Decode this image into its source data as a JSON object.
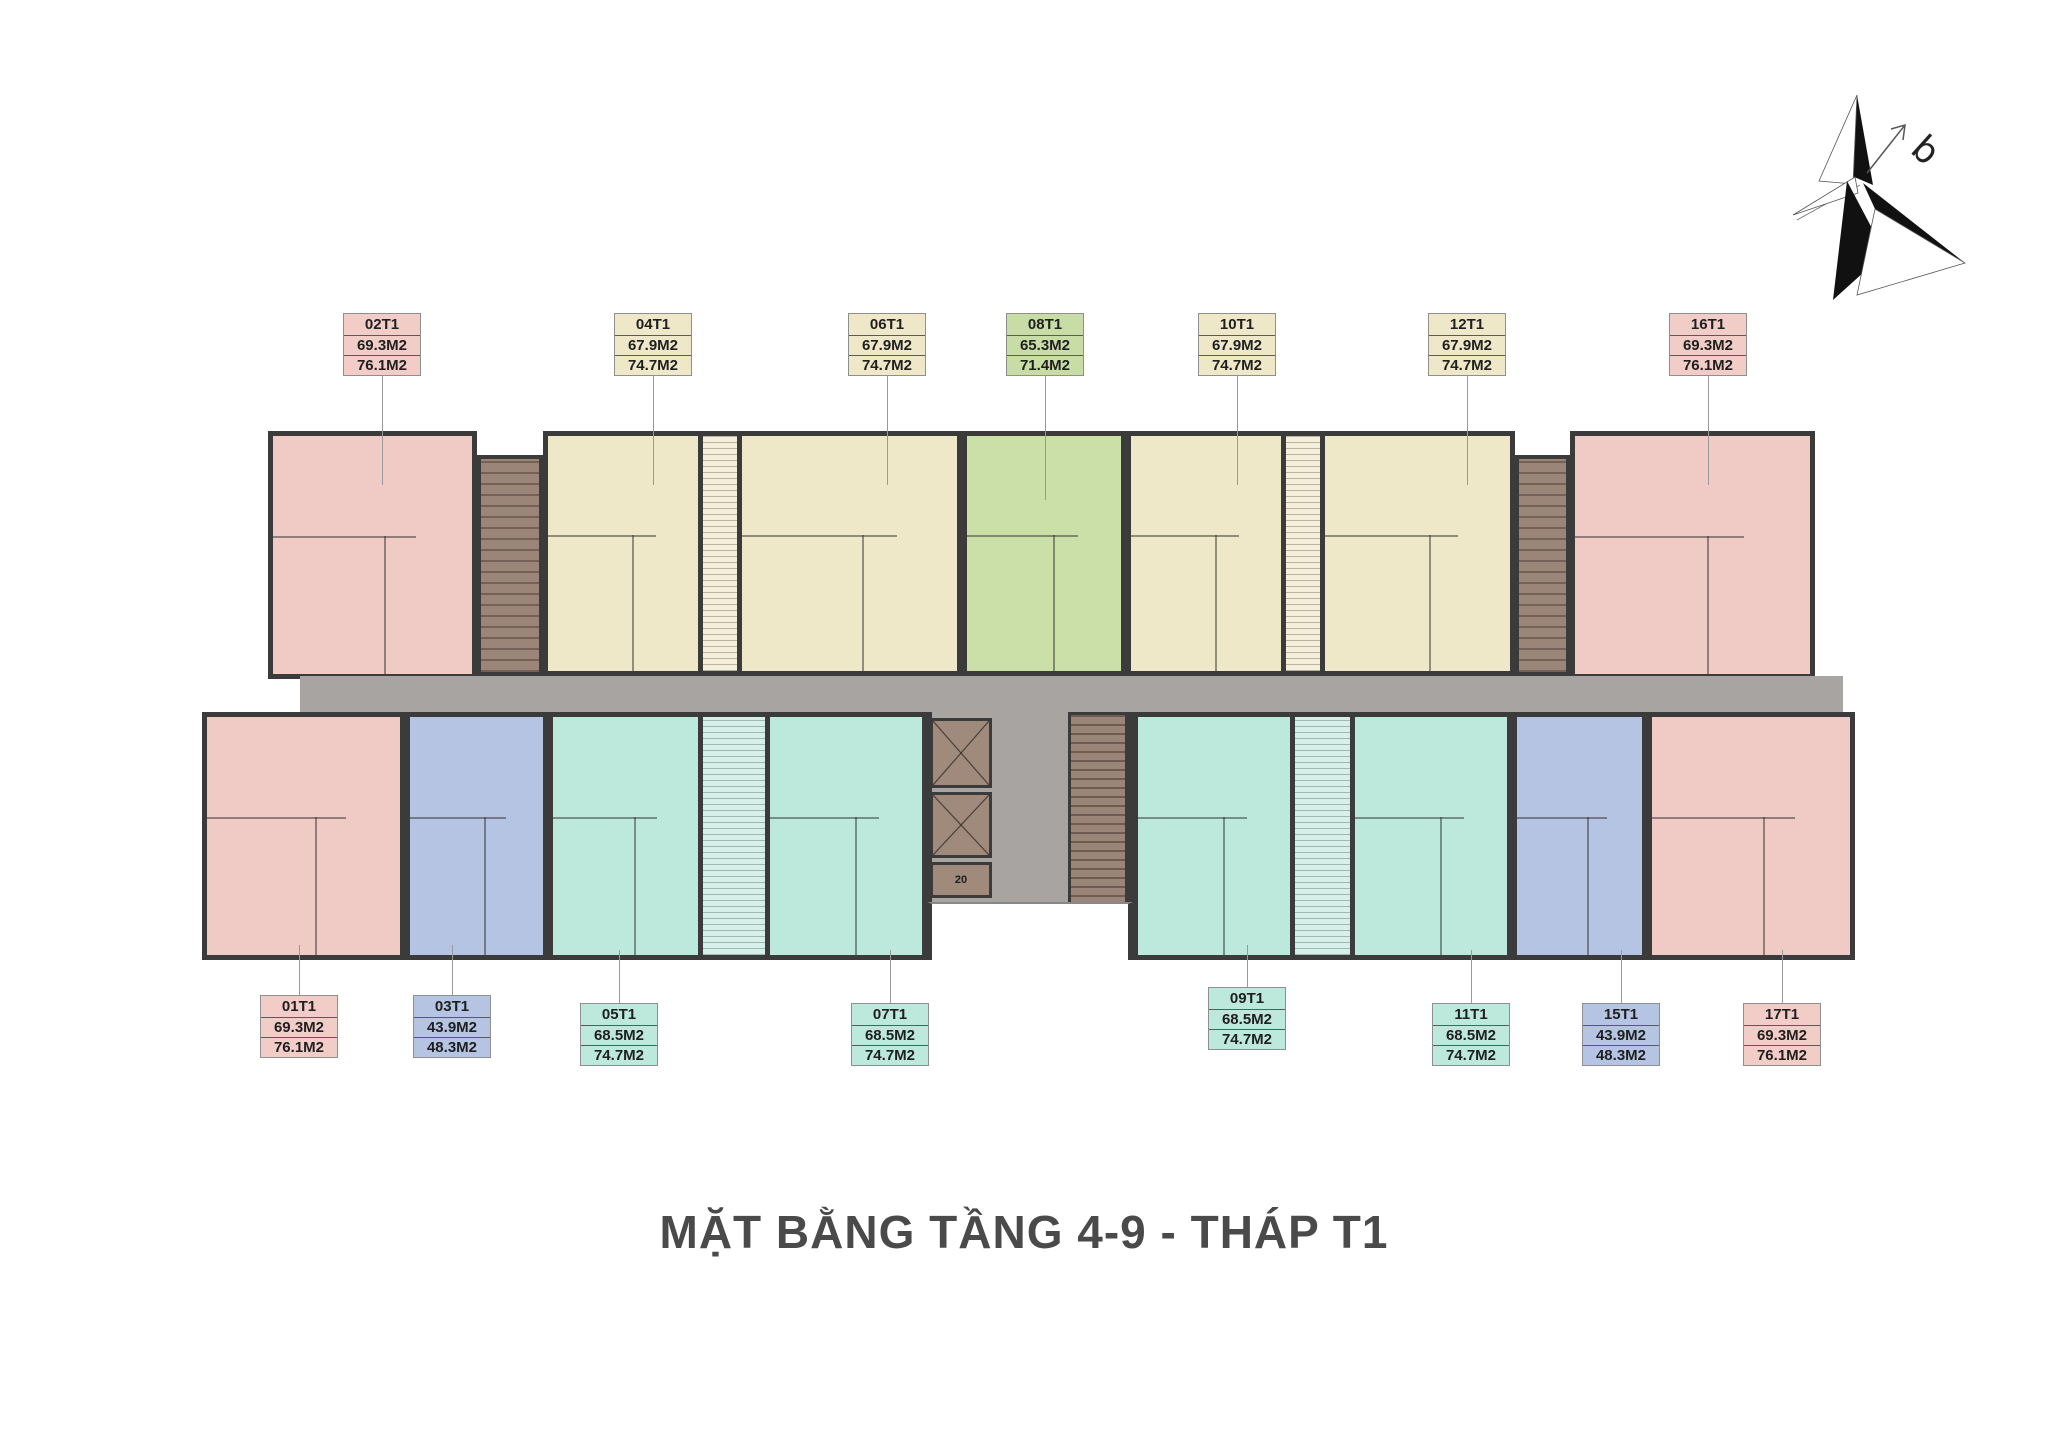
{
  "title": "MẶT BẰNG TẦNG 4-9 - THÁP T1",
  "compass_label": "b",
  "colors": {
    "pink": "#f0cbc5",
    "yellow": "#efe8c8",
    "green": "#cbe0a8",
    "teal": "#bde8dc",
    "blue": "#b4c4e2",
    "corridor_gray": "#a7a4a2",
    "shaft_brown": "#9b8478",
    "wall": "#3b3b3b",
    "title_text": "#4a4a4a"
  },
  "units": {
    "top": [
      {
        "code": "02T1",
        "areas": [
          "69.3M2",
          "76.1M2"
        ],
        "color": "pink"
      },
      {
        "code": "04T1",
        "areas": [
          "67.9M2",
          "74.7M2"
        ],
        "color": "yellow"
      },
      {
        "code": "06T1",
        "areas": [
          "67.9M2",
          "74.7M2"
        ],
        "color": "yellow"
      },
      {
        "code": "08T1",
        "areas": [
          "65.3M2",
          "71.4M2"
        ],
        "color": "green"
      },
      {
        "code": "10T1",
        "areas": [
          "67.9M2",
          "74.7M2"
        ],
        "color": "yellow"
      },
      {
        "code": "12T1",
        "areas": [
          "67.9M2",
          "74.7M2"
        ],
        "color": "yellow"
      },
      {
        "code": "16T1",
        "areas": [
          "69.3M2",
          "76.1M2"
        ],
        "color": "pink"
      }
    ],
    "bottom": [
      {
        "code": "01T1",
        "areas": [
          "69.3M2",
          "76.1M2"
        ],
        "color": "pink"
      },
      {
        "code": "03T1",
        "areas": [
          "43.9M2",
          "48.3M2"
        ],
        "color": "blue"
      },
      {
        "code": "05T1",
        "areas": [
          "68.5M2",
          "74.7M2"
        ],
        "color": "teal"
      },
      {
        "code": "07T1",
        "areas": [
          "68.5M2",
          "74.7M2"
        ],
        "color": "teal"
      },
      {
        "code": "09T1",
        "areas": [
          "68.5M2",
          "74.7M2"
        ],
        "color": "teal"
      },
      {
        "code": "11T1",
        "areas": [
          "68.5M2",
          "74.7M2"
        ],
        "color": "teal"
      },
      {
        "code": "15T1",
        "areas": [
          "43.9M2",
          "48.3M2"
        ],
        "color": "blue"
      },
      {
        "code": "17T1",
        "areas": [
          "69.3M2",
          "76.1M2"
        ],
        "color": "pink"
      }
    ]
  },
  "core": {
    "stair_labels": [
      "20",
      "20"
    ]
  }
}
